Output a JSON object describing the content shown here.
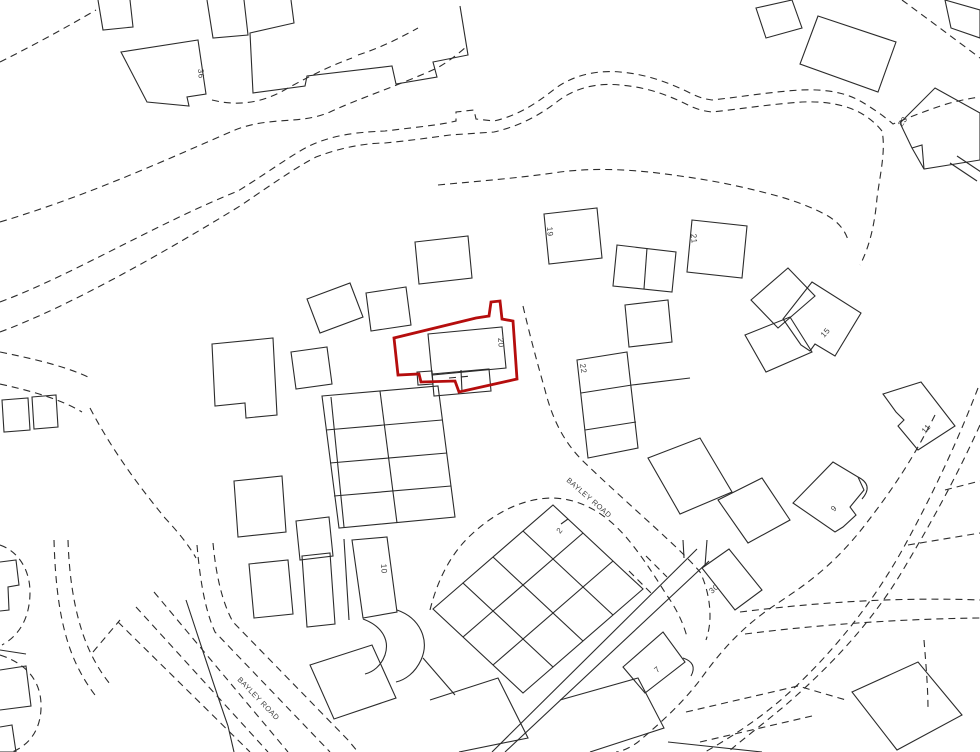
{
  "map": {
    "type": "site-location-plan",
    "palette": {
      "background": "#ffffff",
      "line": "#2b2b2b",
      "highlight": "#b50d0d",
      "label": "#3d3d3d"
    },
    "highlighted_plot_number": "20",
    "road_labels": [
      {
        "text": "BAYLEY ROAD"
      },
      {
        "text": "BAYLEY ROAD"
      }
    ],
    "plot_labels": [
      {
        "text": "36"
      },
      {
        "text": "23"
      },
      {
        "text": "19"
      },
      {
        "text": "21"
      },
      {
        "text": "15"
      },
      {
        "text": "20"
      },
      {
        "text": "22"
      },
      {
        "text": "11"
      },
      {
        "text": "9"
      },
      {
        "text": "30"
      },
      {
        "text": "7"
      },
      {
        "text": "10"
      },
      {
        "text": "2"
      }
    ]
  }
}
